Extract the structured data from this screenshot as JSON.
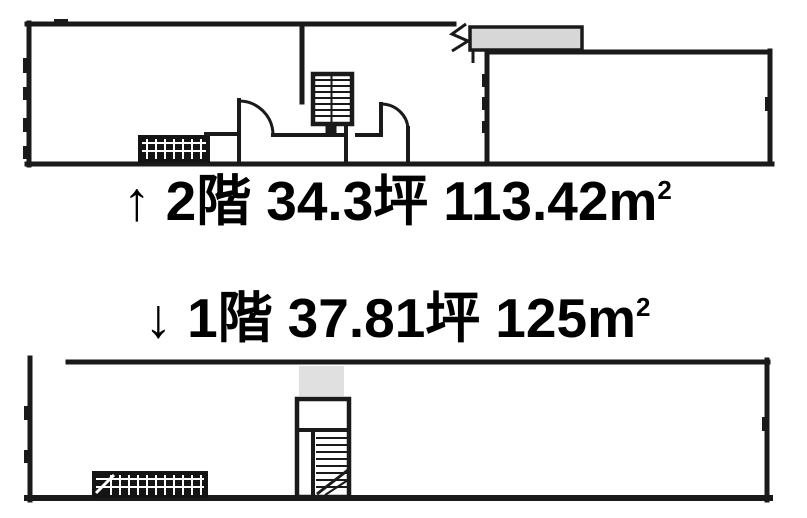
{
  "colors": {
    "background": "#ffffff",
    "wall": "#1a1a1a",
    "canopy": "#d7d7d7",
    "landing": "#e0e0e0",
    "hatch": "#141414",
    "text": "#000000"
  },
  "floors": [
    {
      "arrow": "↑",
      "name": "2階",
      "tsubo": "34.3坪",
      "area": "113.42",
      "area_unit": "m",
      "area_exponent": "2"
    },
    {
      "arrow": "↓",
      "name": "1階",
      "tsubo": "37.81坪",
      "area": "125",
      "area_unit": "m",
      "area_exponent": "2"
    }
  ]
}
